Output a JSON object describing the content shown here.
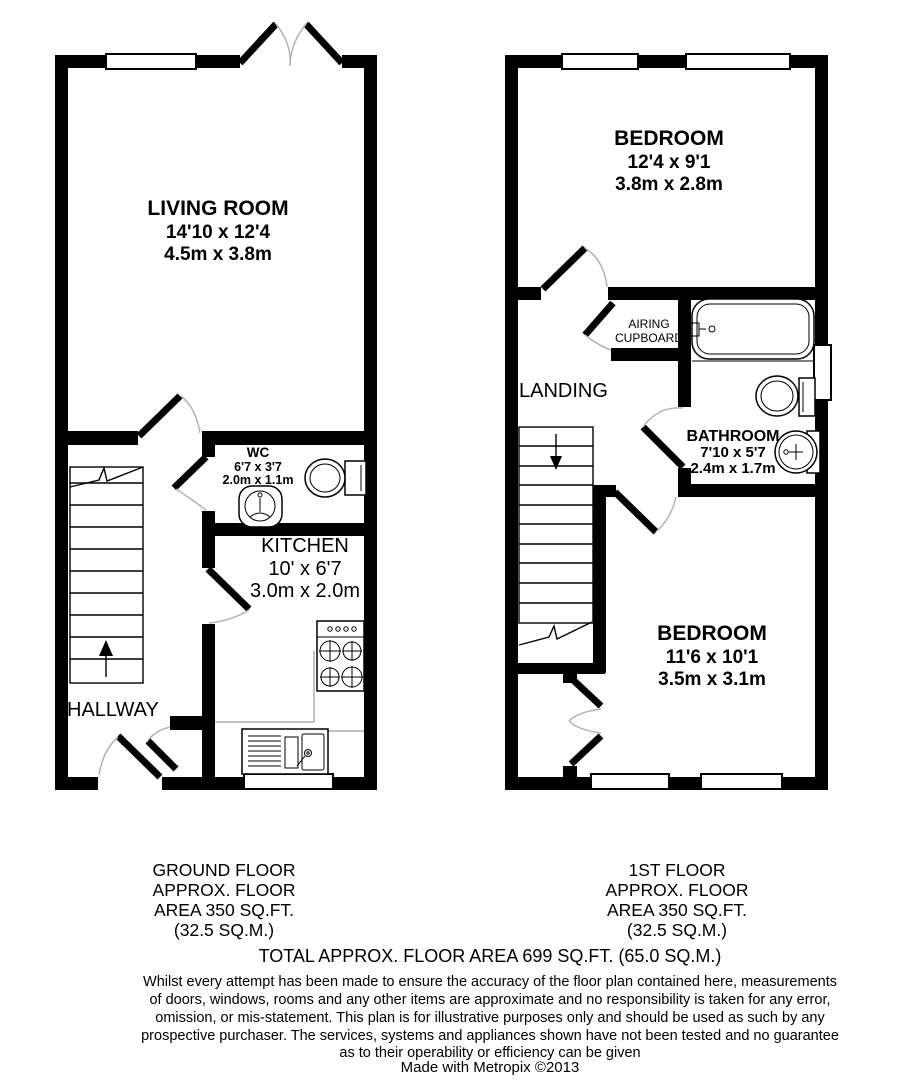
{
  "ground_floor": {
    "caption_lines": [
      "GROUND FLOOR",
      "APPROX. FLOOR",
      "AREA 350 SQ.FT.",
      "(32.5 SQ.M.)"
    ],
    "living_room": {
      "name": "LIVING ROOM",
      "dim_imperial": "14'10 x 12'4",
      "dim_metric": "4.5m x 3.8m"
    },
    "wc": {
      "name": "WC",
      "dim_imperial": "6'7 x 3'7",
      "dim_metric": "2.0m x 1.1m"
    },
    "kitchen": {
      "name": "KITCHEN",
      "dim_imperial": "10' x 6'7",
      "dim_metric": "3.0m x 2.0m"
    },
    "hallway": {
      "name": "HALLWAY"
    }
  },
  "first_floor": {
    "caption_lines": [
      "1ST FLOOR",
      "APPROX. FLOOR",
      "AREA 350 SQ.FT.",
      "(32.5 SQ.M.)"
    ],
    "bedroom_front": {
      "name": "BEDROOM",
      "dim_imperial": "12'4 x 9'1",
      "dim_metric": "3.8m x 2.8m"
    },
    "airing_cupboard": {
      "name_line1": "AIRING",
      "name_line2": "CUPBOARD"
    },
    "landing": {
      "name": "LANDING"
    },
    "bathroom": {
      "name": "BATHROOM",
      "dim_imperial": "7'10 x 5'7",
      "dim_metric": "2.4m x 1.7m"
    },
    "bedroom_back": {
      "name": "BEDROOM",
      "dim_imperial": "11'6 x 10'1",
      "dim_metric": "3.5m x 3.1m"
    }
  },
  "summary": {
    "total": "TOTAL APPROX. FLOOR AREA 699 SQ.FT. (65.0 SQ.M.)"
  },
  "disclaimer_lines": [
    "Whilst every attempt has been made to ensure the accuracy of the floor plan contained here, measurements",
    "of doors, windows, rooms and any other items are approximate and no responsibility is taken for any error,",
    "omission, or mis-statement. This plan is for illustrative purposes only and should be used as such by any",
    "prospective purchaser. The services, systems and appliances shown have not been tested and no guarantee",
    "as to their operability or efficiency can be given"
  ],
  "credit": "Made with Metropix ©2013",
  "colors": {
    "wall": "#000000",
    "background": "#ffffff",
    "door_arc": "#b3b3b3"
  }
}
